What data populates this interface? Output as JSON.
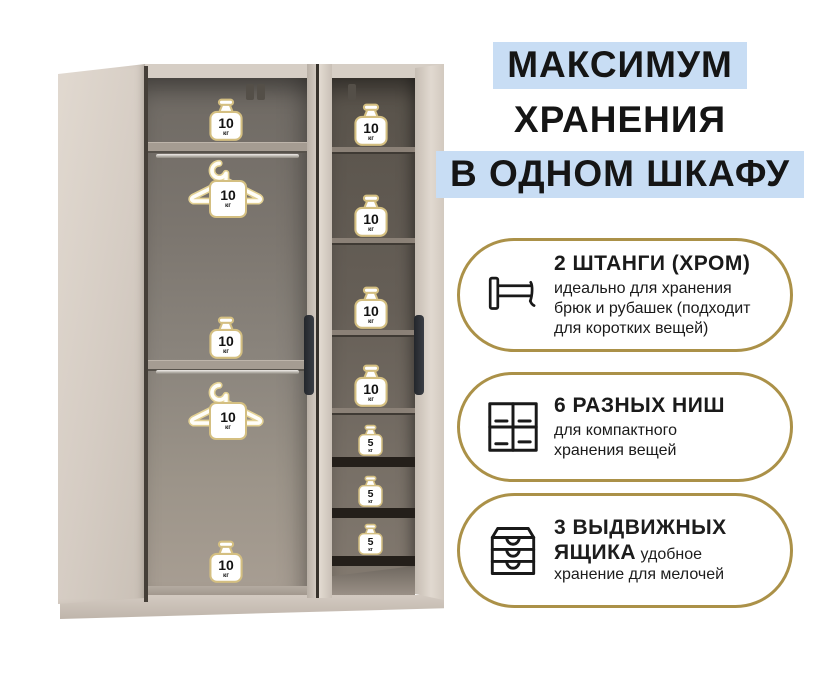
{
  "header": {
    "lines": [
      {
        "text": "МАКСИМУМ",
        "highlight": true
      },
      {
        "text": "ХРАНЕНИЯ",
        "highlight": false
      },
      {
        "text": "В ОДНОМ ШКАФУ",
        "highlight": true
      }
    ]
  },
  "features": [
    {
      "icon": "clothes-rail-icon",
      "title": "2 ШТАНГИ (ХРОМ)",
      "description": "идеально для хранения брюк и рубашек (подходит для коротких вещей)"
    },
    {
      "icon": "compartments-grid-icon",
      "title": "6 РАЗНЫХ НИШ",
      "description": "для компактного хранения вещей"
    },
    {
      "icon": "drawers-icon",
      "title": "3 ВЫДВИЖНЫХ ЯЩИКА",
      "description": "удобное хранение для мелочей"
    }
  ],
  "wardrobe": {
    "left_section": {
      "shelf_weights": [
        {
          "value": "10",
          "unit": "кг"
        },
        {
          "value": "10",
          "unit": "кг"
        },
        {
          "value": "10",
          "unit": "кг"
        }
      ],
      "hanger_weights": [
        {
          "value": "10",
          "unit": "кг"
        },
        {
          "value": "10",
          "unit": "кг"
        }
      ]
    },
    "right_section": {
      "shelf_weights": [
        {
          "value": "10",
          "unit": "кг"
        },
        {
          "value": "10",
          "unit": "кг"
        },
        {
          "value": "10",
          "unit": "кг"
        },
        {
          "value": "10",
          "unit": "кг"
        }
      ],
      "drawer_weights": [
        {
          "value": "5",
          "unit": "кг"
        },
        {
          "value": "5",
          "unit": "кг"
        },
        {
          "value": "5",
          "unit": "кг"
        }
      ]
    }
  },
  "colors": {
    "highlight_blue": "#c8ddf4",
    "accent_gold": "#ab9148",
    "weight_border_gold": "#d4bf81",
    "text_dark": "#1a1a1a"
  }
}
